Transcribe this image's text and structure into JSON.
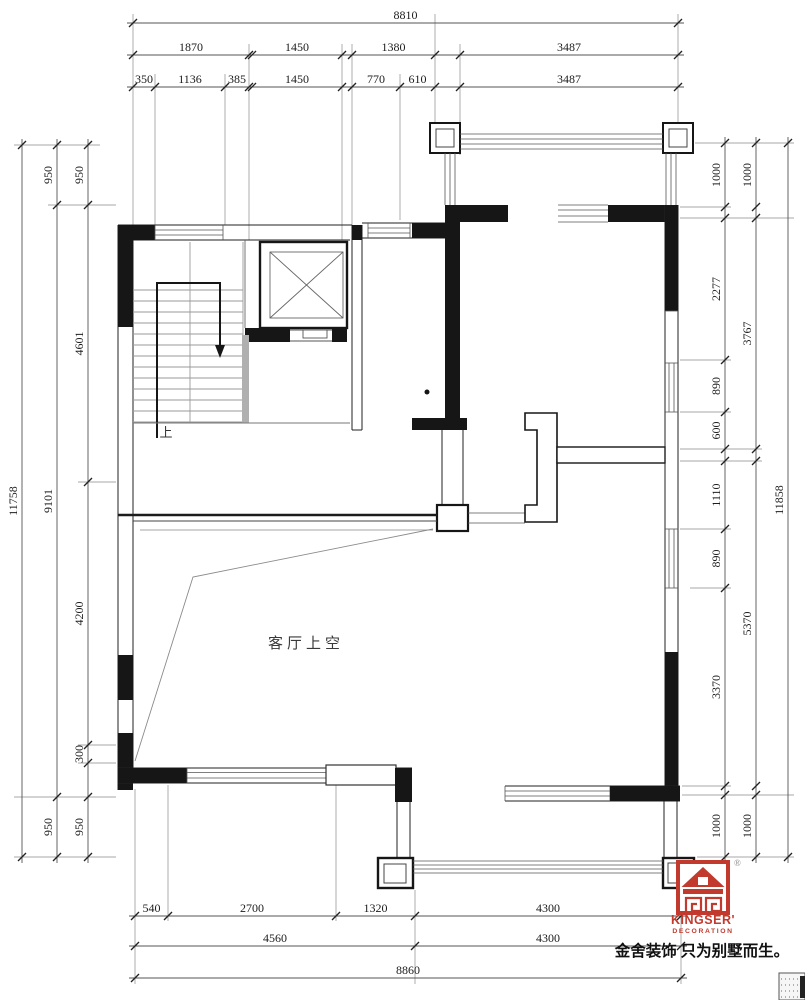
{
  "plan": {
    "living_room_label": "客厅上空",
    "stair_up_label": "上"
  },
  "logo": {
    "brand": "KINGSER'",
    "sub": "DECORATION",
    "registered": "®",
    "tagline": "金舍装饰 只为别墅而生。",
    "red": "#c2392e"
  },
  "colors": {
    "wall": "#161616",
    "thin_line": "#444444",
    "gray_line": "#999999",
    "dim_line": "#555555",
    "ext_line": "#8a8a8a",
    "text": "#1c1c1c"
  },
  "dims": {
    "chains": [
      {
        "id": "top-total",
        "dir": "h",
        "pos": 23,
        "segs": [
          [
            133,
            678,
            "8810"
          ]
        ]
      },
      {
        "id": "top-mid",
        "dir": "h",
        "pos": 55,
        "segs": [
          [
            133,
            249,
            "1870"
          ],
          [
            252,
            342,
            "1450"
          ],
          [
            352,
            435,
            "1380"
          ],
          [
            460,
            678,
            "3487"
          ]
        ]
      },
      {
        "id": "top-inner",
        "dir": "h",
        "pos": 87,
        "segs": [
          [
            133,
            155,
            "350"
          ],
          [
            155,
            225,
            "1136"
          ],
          [
            225,
            249,
            "385"
          ],
          [
            252,
            342,
            "1450"
          ],
          [
            352,
            400,
            "770"
          ],
          [
            400,
            435,
            "610"
          ],
          [
            460,
            678,
            "3487"
          ]
        ]
      },
      {
        "id": "bottom-inner",
        "dir": "h",
        "pos": 916,
        "segs": [
          [
            135,
            168,
            "540"
          ],
          [
            168,
            336,
            "2700"
          ],
          [
            336,
            415,
            "1320"
          ],
          [
            415,
            681,
            "4300"
          ]
        ]
      },
      {
        "id": "bottom-mid",
        "dir": "h",
        "pos": 946,
        "segs": [
          [
            135,
            415,
            "4560"
          ],
          [
            415,
            681,
            "4300"
          ]
        ]
      },
      {
        "id": "bottom-total",
        "dir": "h",
        "pos": 978,
        "segs": [
          [
            135,
            681,
            "8860"
          ]
        ]
      },
      {
        "id": "left-total",
        "dir": "v",
        "pos": 22,
        "segs": [
          [
            145,
            857,
            "11758"
          ]
        ]
      },
      {
        "id": "left-mid",
        "dir": "v",
        "pos": 57,
        "segs": [
          [
            145,
            205,
            "950"
          ],
          [
            205,
            797,
            "9101"
          ],
          [
            797,
            857,
            "950"
          ]
        ]
      },
      {
        "id": "left-inner",
        "dir": "v",
        "pos": 88,
        "segs": [
          [
            145,
            205,
            "950"
          ],
          [
            205,
            482,
            "4601"
          ],
          [
            482,
            745,
            "4200"
          ],
          [
            745,
            763,
            "300"
          ],
          [
            797,
            857,
            "950"
          ]
        ]
      },
      {
        "id": "right-inner",
        "dir": "v",
        "pos": 725,
        "segs": [
          [
            143,
            207,
            "1000"
          ],
          [
            218,
            360,
            "2277"
          ],
          [
            360,
            412,
            "890"
          ],
          [
            412,
            449,
            "600"
          ],
          [
            461,
            529,
            "1110"
          ],
          [
            529,
            588,
            "890"
          ],
          [
            588,
            786,
            "3370"
          ],
          [
            795,
            857,
            "1000"
          ]
        ]
      },
      {
        "id": "right-mid",
        "dir": "v",
        "pos": 756,
        "segs": [
          [
            143,
            207,
            "1000"
          ],
          [
            218,
            449,
            "3767"
          ],
          [
            461,
            786,
            "5370"
          ],
          [
            795,
            857,
            "1000"
          ]
        ]
      },
      {
        "id": "right-total",
        "dir": "v",
        "pos": 788,
        "segs": [
          [
            143,
            857,
            "11858"
          ]
        ]
      }
    ],
    "ext_lines": [
      [
        133,
        14,
        133,
        225
      ],
      [
        155,
        74,
        155,
        225
      ],
      [
        225,
        74,
        225,
        225
      ],
      [
        249,
        44,
        249,
        240
      ],
      [
        342,
        44,
        342,
        240
      ],
      [
        352,
        44,
        352,
        225
      ],
      [
        400,
        74,
        400,
        220
      ],
      [
        435,
        14,
        435,
        126
      ],
      [
        460,
        44,
        460,
        155
      ],
      [
        678,
        14,
        678,
        126
      ],
      [
        135,
        789,
        135,
        984
      ],
      [
        168,
        785,
        168,
        921
      ],
      [
        336,
        785,
        336,
        921
      ],
      [
        415,
        890,
        415,
        984
      ],
      [
        681,
        890,
        681,
        984
      ],
      [
        14,
        145,
        100,
        145
      ],
      [
        48,
        205,
        116,
        205
      ],
      [
        78,
        482,
        116,
        482
      ],
      [
        78,
        745,
        116,
        745
      ],
      [
        78,
        763,
        116,
        763
      ],
      [
        14,
        797,
        116,
        797
      ],
      [
        14,
        857,
        116,
        857
      ],
      [
        695,
        143,
        794,
        143
      ],
      [
        680,
        207,
        731,
        207
      ],
      [
        680,
        218,
        794,
        218
      ],
      [
        680,
        360,
        731,
        360
      ],
      [
        680,
        412,
        731,
        412
      ],
      [
        680,
        449,
        762,
        449
      ],
      [
        680,
        461,
        762,
        461
      ],
      [
        680,
        529,
        731,
        529
      ],
      [
        690,
        588,
        731,
        588
      ],
      [
        682,
        786,
        731,
        786
      ],
      [
        682,
        795,
        794,
        795
      ],
      [
        697,
        857,
        794,
        857
      ]
    ]
  }
}
